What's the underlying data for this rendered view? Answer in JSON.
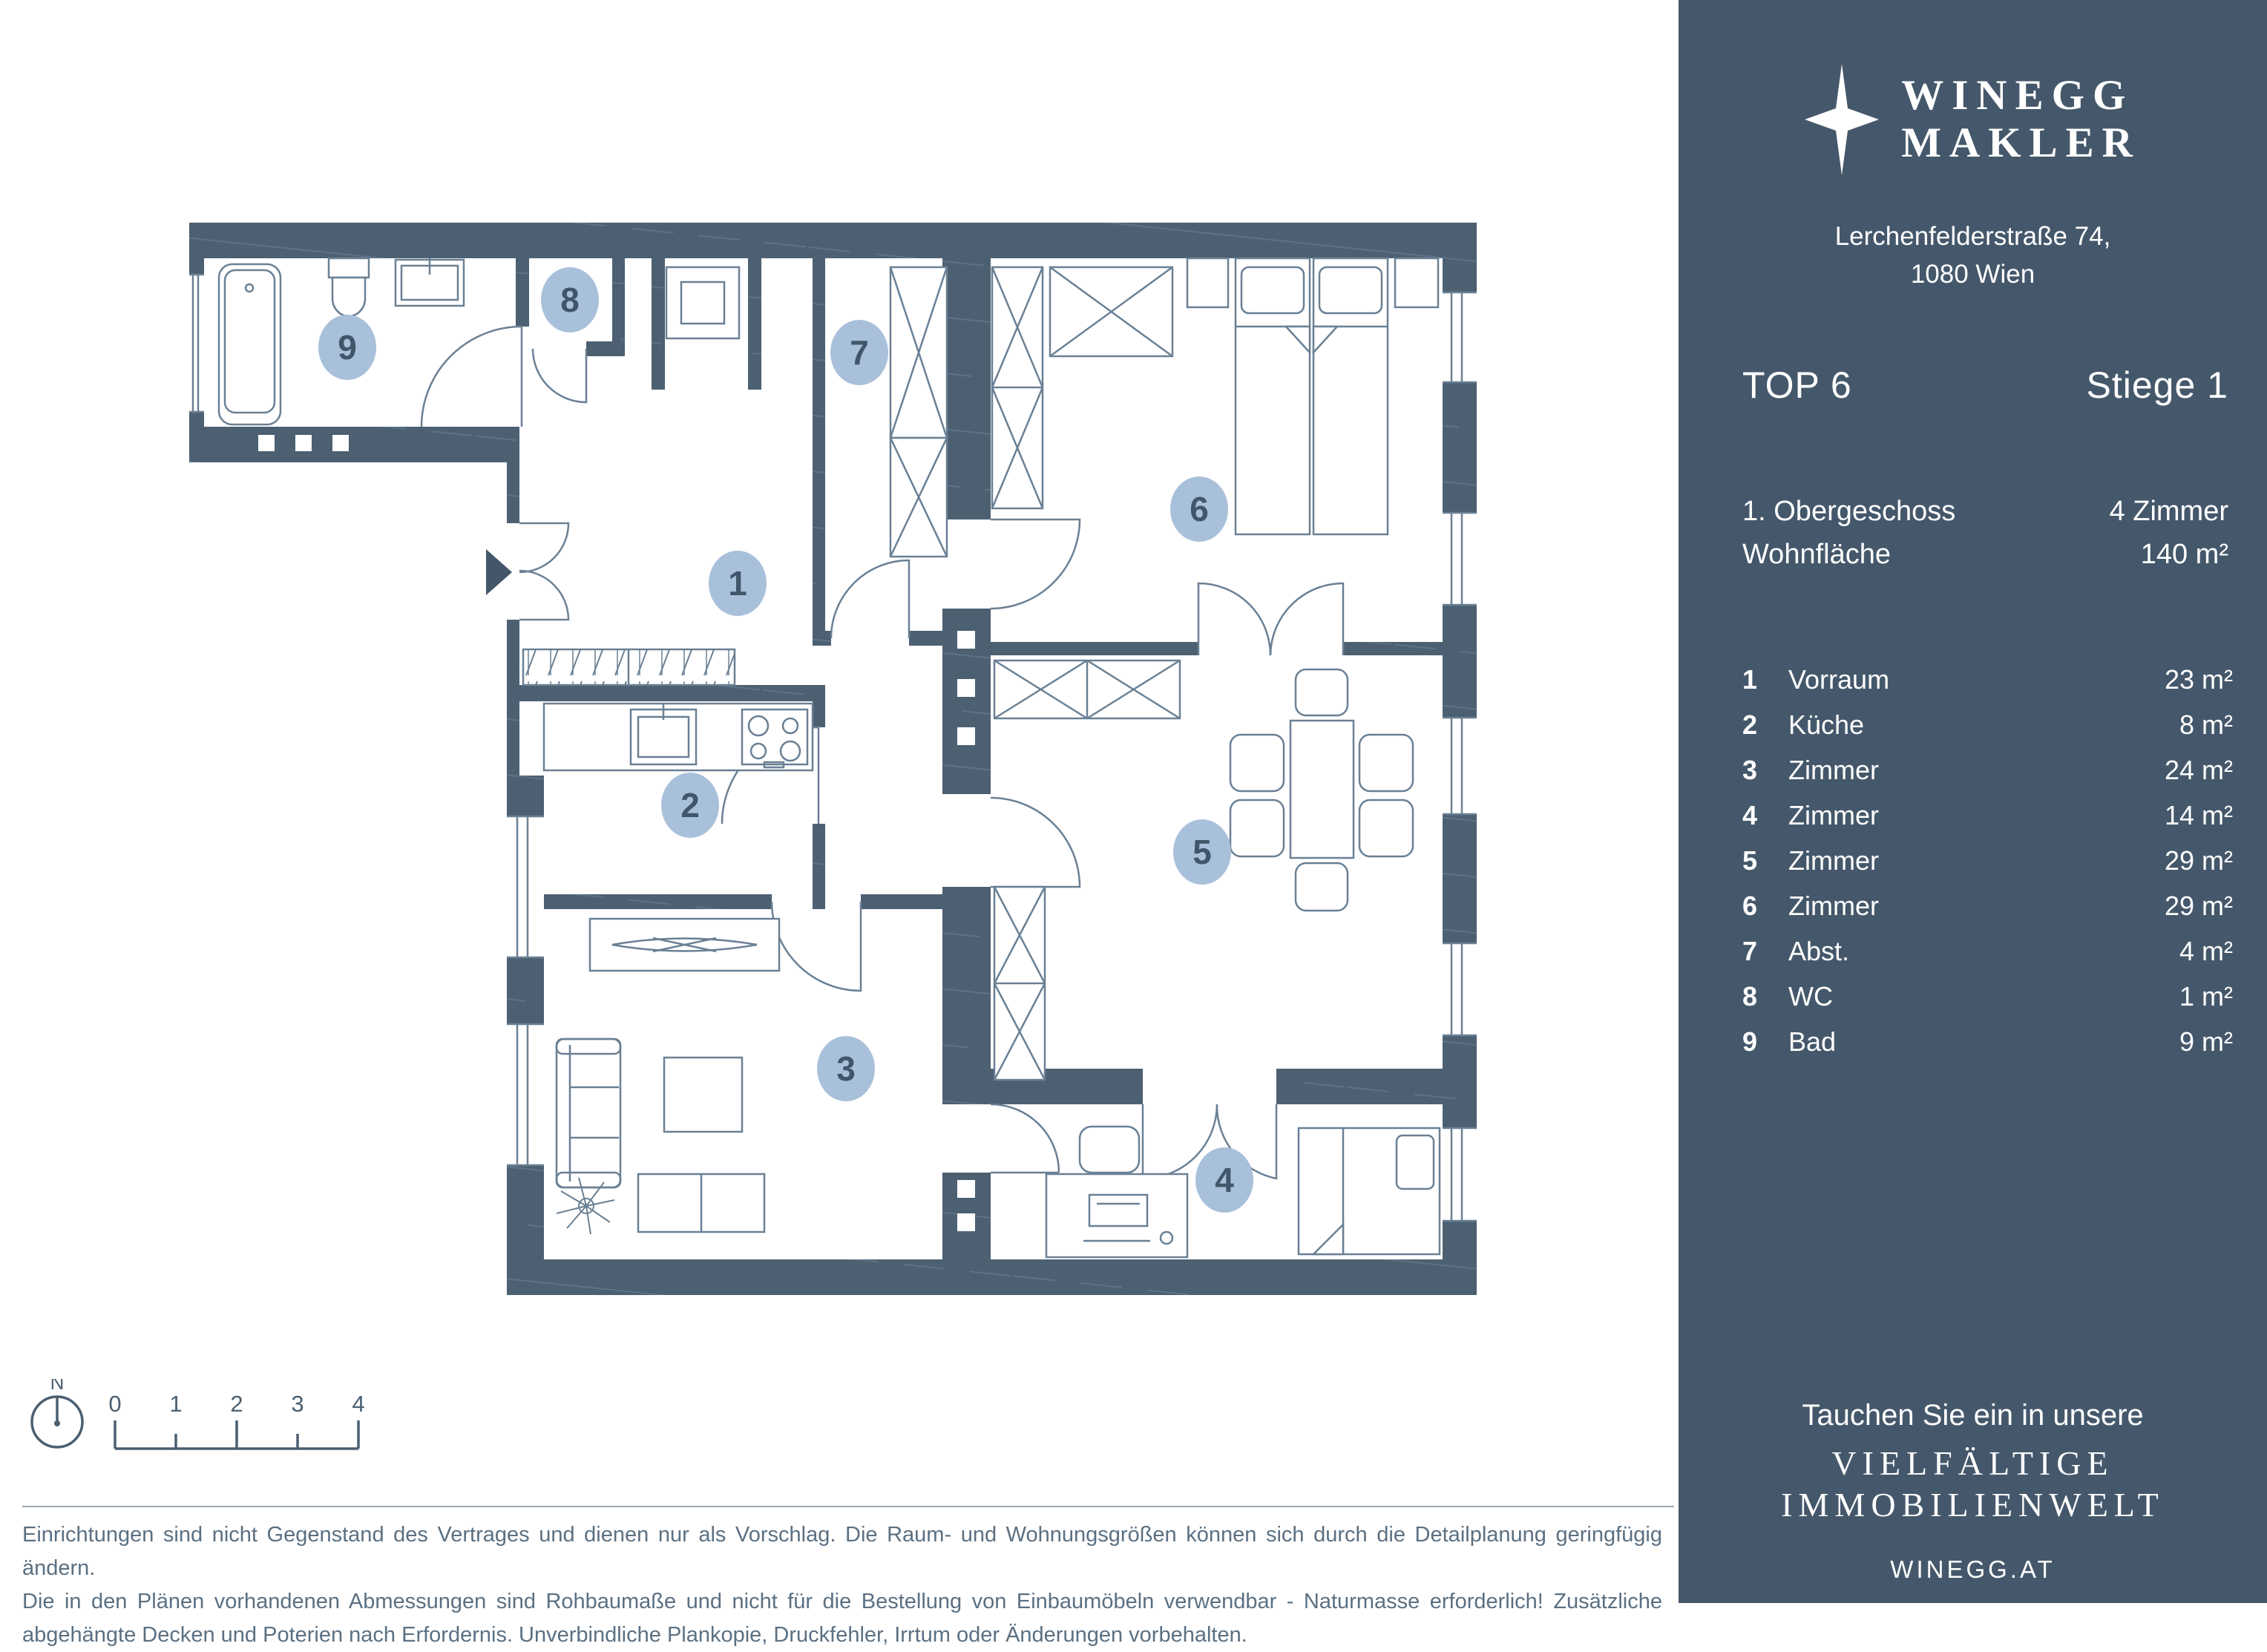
{
  "colors": {
    "sidebar_bg": "#45586b",
    "wall": "#4c6072",
    "wall_hatch": "#5d7285",
    "furniture_line": "#6a8094",
    "marker_fill": "#a9c0da",
    "marker_text": "#3f566b",
    "disclaimer_text": "#5b7082"
  },
  "sidebar": {
    "logo": {
      "brand_line1": "WINEGG",
      "brand_line2": "MAKLER"
    },
    "address_line1": "Lerchenfelderstraße 74,",
    "address_line2": "1080 Wien",
    "unit_label": "TOP 6",
    "stair_label": "Stiege 1",
    "info_rows": [
      {
        "label": "1. Obergeschoss",
        "value": "4 Zimmer"
      },
      {
        "label": "Wohnfläche",
        "value": "140 m²"
      }
    ],
    "footer": {
      "line1": "Tauchen Sie ein in unsere",
      "line2": "VIELFÄLTIGE",
      "line3": "IMMOBILIENWELT",
      "website": "WINEGG.AT"
    }
  },
  "rooms": [
    {
      "nr": "1",
      "label": "Vorraum",
      "area": "23 m²"
    },
    {
      "nr": "2",
      "label": "Küche",
      "area": "8 m²"
    },
    {
      "nr": "3",
      "label": "Zimmer",
      "area": "24 m²"
    },
    {
      "nr": "4",
      "label": "Zimmer",
      "area": "14 m²"
    },
    {
      "nr": "5",
      "label": "Zimmer",
      "area": "29 m²"
    },
    {
      "nr": "6",
      "label": "Zimmer",
      "area": "29 m²"
    },
    {
      "nr": "7",
      "label": "Abst.",
      "area": "4 m²"
    },
    {
      "nr": "8",
      "label": "WC",
      "area": "1 m²"
    },
    {
      "nr": "9",
      "label": "Bad",
      "area": "9 m²"
    }
  ],
  "scalebar": {
    "north_label": "N",
    "tick_labels": [
      "0",
      "1",
      "2",
      "3",
      "4"
    ]
  },
  "disclaimer": {
    "line1": "Einrichtungen sind nicht Gegenstand des Vertrages und dienen nur als Vorschlag. Die Raum- und Wohnungsgrößen können sich durch die Detailplanung geringfügig ändern.",
    "line2": "Die in den Plänen vorhandenen Abmessungen sind Rohbaumaße und nicht für die Bestellung von Einbaumöbeln verwendbar - Naturmasse erforderlich! Zusätzliche",
    "line3": "abgehängte Decken und Poterien nach Erfordernis. Unverbindliche Plankopie, Druckfehler, Irrtum oder Änderungen vorbehalten."
  }
}
